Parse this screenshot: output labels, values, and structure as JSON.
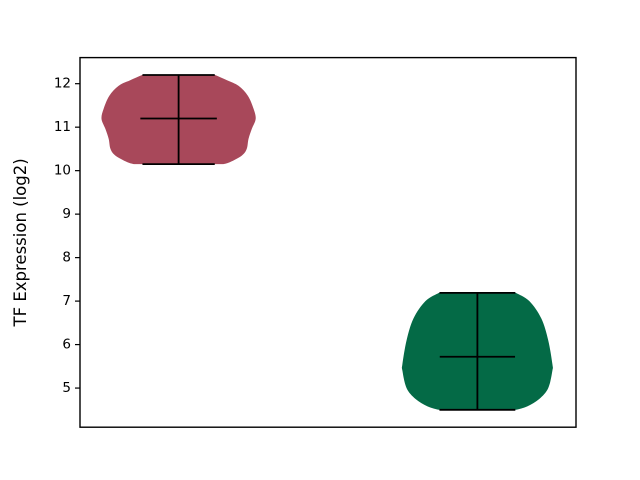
{
  "canvas": {
    "background": "#ffffff",
    "width": 640,
    "height": 480
  },
  "chart_data": {
    "type": "violin",
    "title": "",
    "xlabel": "",
    "ylabel": "TF Expression (log2)",
    "yticks": [
      5,
      6,
      7,
      8,
      9,
      10,
      11,
      12
    ],
    "xticks": [],
    "ylim": [
      4.1,
      12.6
    ],
    "xlim": [
      0.67,
      2.33
    ],
    "grid": false,
    "legend": "none",
    "spine_color": "#000000",
    "line_color": "#000000",
    "series": [
      {
        "name": "group-1",
        "position": 1,
        "fill_color": "#a8485a",
        "stats": {
          "min": 10.15,
          "median": 11.2,
          "max": 12.2
        },
        "density_profile": [
          [
            12.2,
            0.122
          ],
          [
            12.08,
            0.162
          ],
          [
            11.95,
            0.201
          ],
          [
            11.72,
            0.232
          ],
          [
            11.42,
            0.251
          ],
          [
            11.19,
            0.258
          ],
          [
            10.96,
            0.245
          ],
          [
            10.73,
            0.234
          ],
          [
            10.5,
            0.228
          ],
          [
            10.35,
            0.212
          ],
          [
            10.2,
            0.173
          ],
          [
            10.15,
            0.15
          ]
        ],
        "bar_halfwidth": 0.121,
        "median_halfwidth": 0.128
      },
      {
        "name": "group-2",
        "position": 2,
        "fill_color": "#046a46",
        "stats": {
          "min": 4.5,
          "median": 5.72,
          "max": 7.19
        },
        "density_profile": [
          [
            7.19,
            0.129
          ],
          [
            7.0,
            0.174
          ],
          [
            6.6,
            0.214
          ],
          [
            6.1,
            0.237
          ],
          [
            5.55,
            0.251
          ],
          [
            5.4,
            0.251
          ],
          [
            5.0,
            0.237
          ],
          [
            4.75,
            0.207
          ],
          [
            4.58,
            0.167
          ],
          [
            4.5,
            0.129
          ]
        ],
        "bar_halfwidth": 0.127,
        "median_halfwidth": 0.126
      }
    ]
  }
}
